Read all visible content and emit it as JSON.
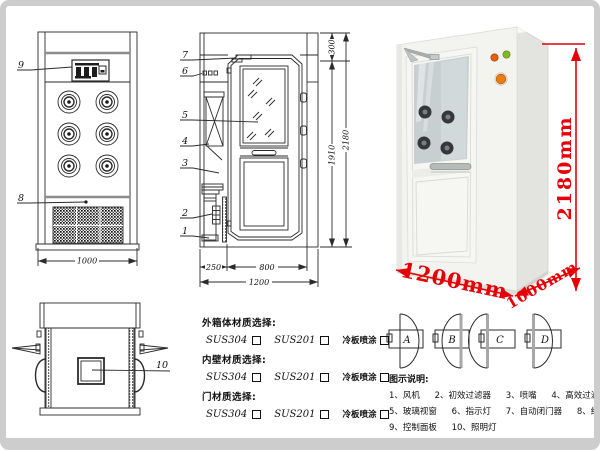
{
  "callouts": {
    "front": [
      "9",
      "8"
    ],
    "side": [
      "7",
      "6",
      "5",
      "4",
      "3",
      "2",
      "1"
    ],
    "top": [
      "10"
    ]
  },
  "dimensions": {
    "front_view_width": "1000",
    "side_view": {
      "top": "300",
      "door_height": "1910",
      "total_height": "2180",
      "left": "250",
      "door_width": "800",
      "total_width": "1200"
    }
  },
  "photo": {
    "height_label": "2180mm",
    "width_label": "1200mm",
    "depth_label": "1000mm"
  },
  "door_types": [
    "A",
    "B",
    "C",
    "D"
  ],
  "materials": {
    "groups": [
      {
        "label": "外箱体材质选择:",
        "options": [
          "SUS304",
          "SUS201",
          "冷板喷涂"
        ]
      },
      {
        "label": "内壁材质选择:",
        "options": [
          "SUS304",
          "SUS201",
          "冷板喷涂"
        ]
      },
      {
        "label": "门材质选择:",
        "options": [
          "SUS304",
          "SUS201",
          "冷板喷涂"
        ]
      }
    ]
  },
  "legend": {
    "title": "图示说明:",
    "items": [
      "1、风机",
      "2、初效过滤器",
      "3、喷嘴",
      "4、高效过滤器",
      "5、玻璃视窗",
      "6、指示灯",
      "7、自动闭门器",
      "8、红外线感应器",
      "9、控制面板",
      "10、照明灯"
    ]
  },
  "colors": {
    "dimension_red": "#e60008",
    "line": "#2b2b2b"
  }
}
